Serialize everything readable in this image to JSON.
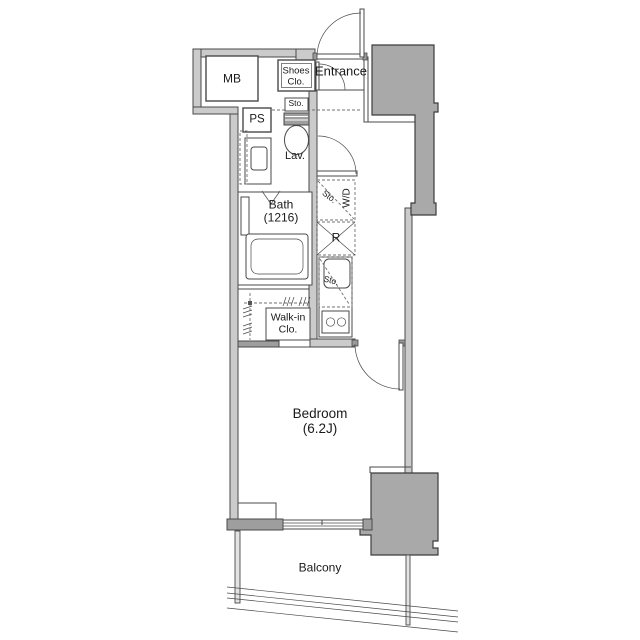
{
  "theme": {
    "wall_fill": "#cbcbcb",
    "pillar_fill": "#a9a9a9",
    "dark_wall_fill": "#9e9e9e",
    "line_color": "#4a4a4a",
    "text_color": "#1a1a1a",
    "background": "#ffffff"
  },
  "floorplan": {
    "labels": {
      "mb": "MB",
      "ps": "PS",
      "shoes_closet": "Shoes\nClo.",
      "entrance": "Entrance",
      "hall_storage": "Sto.",
      "lavatory": "Lav.",
      "bath": "Bath\n(1216)",
      "laundry_storage": "Sto.",
      "washer_dryer": "W/D",
      "refrigerator": "R",
      "kitchen_storage": "Sto.",
      "walk_in_closet": "Walk-in\nClo.",
      "bedroom": "Bedroom\n(6.2J)",
      "balcony": "Balcony"
    }
  }
}
